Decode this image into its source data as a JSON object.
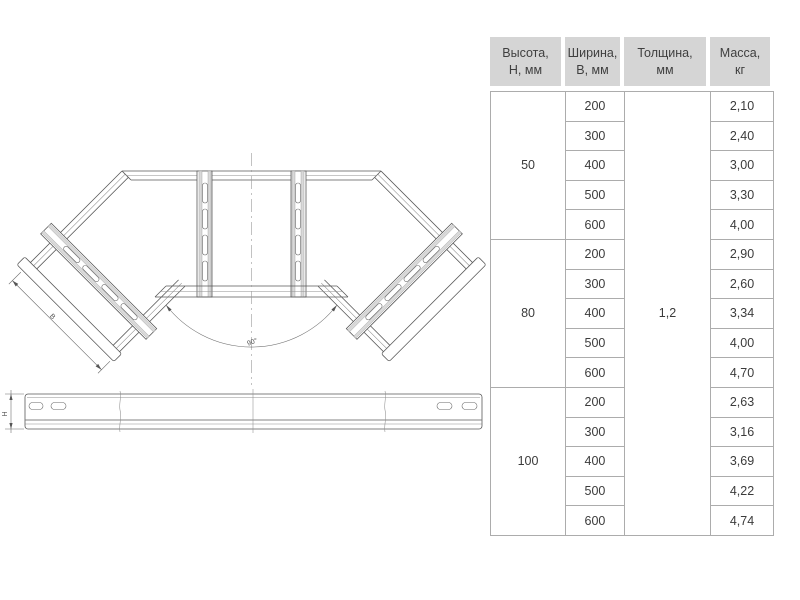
{
  "table": {
    "headers": [
      {
        "line1": "Высота,",
        "line2": "Н, мм"
      },
      {
        "line1": "Ширина,",
        "line2": "В, мм"
      },
      {
        "line1": "Толщина,",
        "line2": "мм"
      },
      {
        "line1": "Масса,",
        "line2": "кг"
      }
    ],
    "thickness": "1,2",
    "groups": [
      {
        "height": "50",
        "rows": [
          [
            "200",
            "2,10"
          ],
          [
            "300",
            "2,40"
          ],
          [
            "400",
            "3,00"
          ],
          [
            "500",
            "3,30"
          ],
          [
            "600",
            "4,00"
          ]
        ]
      },
      {
        "height": "80",
        "rows": [
          [
            "200",
            "2,90"
          ],
          [
            "300",
            "2,60"
          ],
          [
            "400",
            "3,34"
          ],
          [
            "500",
            "4,00"
          ],
          [
            "600",
            "4,70"
          ]
        ]
      },
      {
        "height": "100",
        "rows": [
          [
            "200",
            "2,63"
          ],
          [
            "300",
            "3,16"
          ],
          [
            "400",
            "3,69"
          ],
          [
            "500",
            "4,22"
          ],
          [
            "600",
            "4,74"
          ]
        ]
      }
    ]
  },
  "drawing": {
    "labels": {
      "angle": "90°",
      "width_dim": "B",
      "height_dim": "H"
    }
  }
}
